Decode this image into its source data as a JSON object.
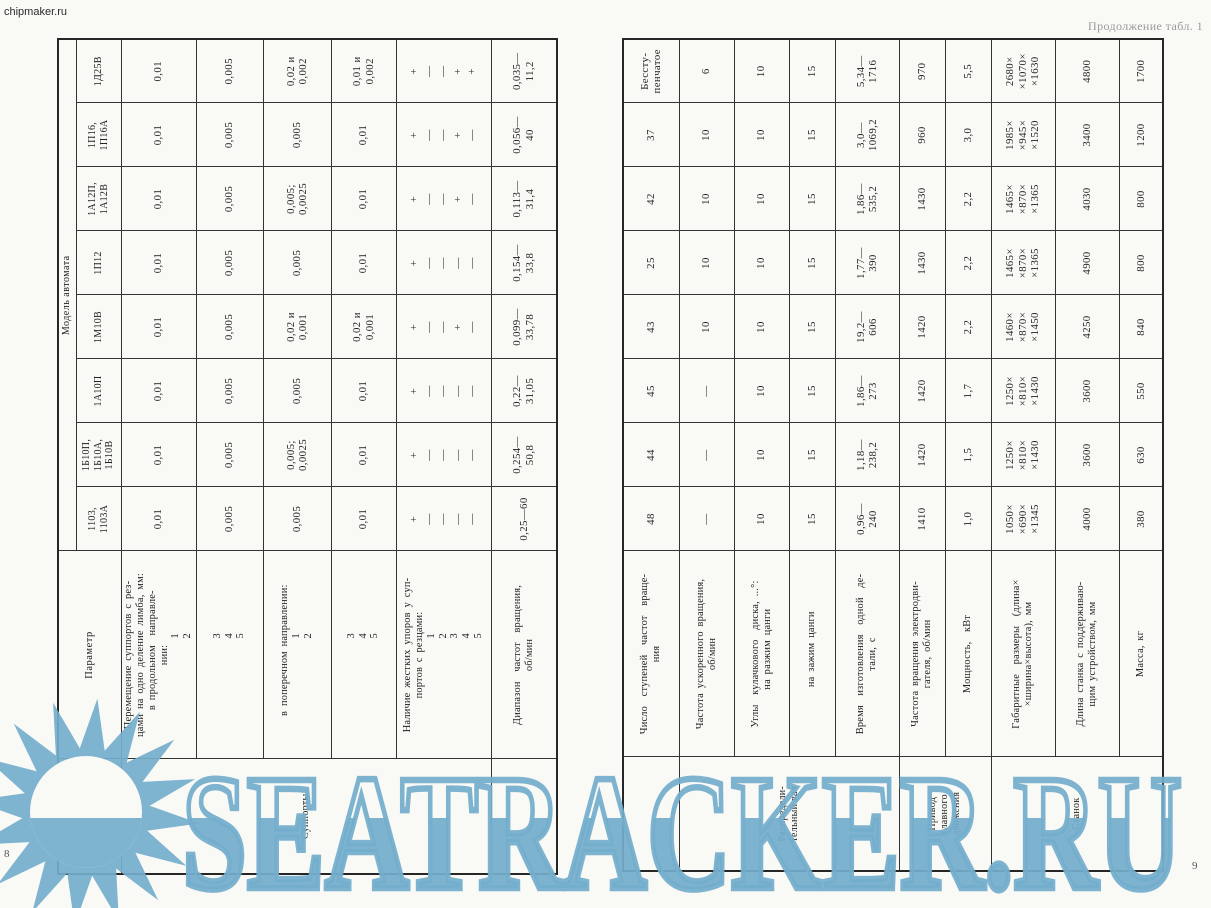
{
  "page": {
    "chipmaker": "chipmaker.ru",
    "caption": "Продолжение табл. 1",
    "page_number_left": "8",
    "page_number_right": "9",
    "watermark": {
      "text": "SEATRACKER.RU",
      "color": "#74aecd",
      "logo": "sun-over-sea-icon"
    }
  },
  "left_table": {
    "object_label": "Объект",
    "parameter_label": "Параметр",
    "model_group_label": "Модель автомата",
    "models": [
      "1103,\n1103А",
      "1Б10П,\n1Б10А,\n1Б10В",
      "1А10П",
      "1М10В",
      "1П12",
      "1А12П,\n1А12В",
      "1П16,\n1П16А",
      "1Д25В"
    ],
    "object_groups": [
      {
        "label": "Суппорты",
        "rows": 5
      },
      {
        "label": "",
        "rows": 1
      }
    ],
    "rows": [
      {
        "parameter": "Перемещение суппортов с рез-\nцами на одно деление лимба, мм:\n  в продольном  направле-\nнии:\n        1\n        2",
        "values": [
          "0,01",
          "0,01",
          "0,01",
          "0,01",
          "0,01",
          "0,01",
          "0,01",
          "0,01"
        ]
      },
      {
        "parameter": "        3\n        4\n        5",
        "values": [
          "0,005",
          "0,005",
          "0,005",
          "0,005",
          "0,005",
          "0,005",
          "0,005",
          "0,005"
        ]
      },
      {
        "parameter": "  в поперечном направлении:\n        1\n        2",
        "values": [
          "0,005",
          "0,005;\n0,0025",
          "0,005",
          "0,02 и\n0,001",
          "0,005",
          "0,005;\n0,0025",
          "0,005",
          "0,02 и\n0,002"
        ]
      },
      {
        "parameter": "        3\n        4\n        5",
        "values": [
          "0,01",
          "0,01",
          "0,01",
          "0,02 и\n0,001",
          "0,01",
          "0,01",
          "0,01",
          "0,01 и\n0,002"
        ]
      },
      {
        "parameter": "Наличие жестких упоров у суп-\nпортов с резцами:\n        1\n        2\n        3\n        4\n        5",
        "values": [
          "+\n—\n—\n—\n—",
          "+\n—\n—\n—\n—",
          "+\n—\n—\n—\n—",
          "+\n—\n—\n+\n—",
          "+\n—\n—\n—\n—",
          "+\n—\n—\n+\n—",
          "+\n—\n—\n+\n—",
          "+\n—\n—\n+\n+"
        ],
        "style": "stops"
      },
      {
        "parameter": "Диапазон  частот  вращения,\nоб/мин",
        "values": [
          "0,25—60",
          "0,254—\n50,8",
          "0,22—\n31,05",
          "0,099—\n33,78",
          "0,154—\n33,8",
          "0,113—\n31,4",
          "0,056—\n40",
          "0,035—\n11,2"
        ]
      }
    ]
  },
  "right_table": {
    "object_groups": [
      {
        "label": "",
        "rows": 1
      },
      {
        "label": "Распредели-\nтельный вал",
        "rows": 4
      },
      {
        "label": "Привод\nглавного\nдвижения",
        "rows": 2
      },
      {
        "label": "Станок",
        "rows": 3
      }
    ],
    "rows": [
      {
        "parameter": "Число  ступеней  частот  враще-\nния",
        "values": [
          "48",
          "44",
          "45",
          "43",
          "25",
          "42",
          "37",
          "Бессту-\nпенчатое"
        ]
      },
      {
        "parameter": "Частота ускоренного вращения,\nоб/мин",
        "values": [
          "—",
          "—",
          "—",
          "10",
          "10",
          "10",
          "10",
          "6"
        ]
      },
      {
        "parameter": "Углы  кулачкового  диска, ...°:\n  на разжим цанги",
        "values": [
          "10",
          "10",
          "10",
          "10",
          "10",
          "10",
          "10",
          "10"
        ]
      },
      {
        "parameter": "  на зажим цанги",
        "values": [
          "15",
          "15",
          "15",
          "15",
          "15",
          "15",
          "15",
          "15"
        ]
      },
      {
        "parameter": "Время  изготовления  одной  де-\nтали, с",
        "values": [
          "0,96—\n240",
          "1,18—\n238,2",
          "1,86—\n273",
          "19,2—\n606",
          "1,77—\n390",
          "1,86—\n535,2",
          "3,0—\n1069,2",
          "5,34—\n1716"
        ]
      },
      {
        "parameter": "Частота вращения электродви-\nгателя, об/мин",
        "values": [
          "1410",
          "1420",
          "1420",
          "1420",
          "1430",
          "1430",
          "960",
          "970"
        ]
      },
      {
        "parameter": "Мощность,  кВт",
        "values": [
          "1,0",
          "1,5",
          "1,7",
          "2,2",
          "2,2",
          "2,2",
          "3,0",
          "5,5"
        ]
      },
      {
        "parameter": "Габаритные  размеры  (длина×\n×ширина×высота), мм",
        "values": [
          "1050×\n×690×\n×1345",
          "1250×\n×810×\n×1430",
          "1250×\n×810×\n×1430",
          "1460×\n×870×\n×1450",
          "1465×\n×870×\n×1365",
          "1465×\n×870×\n×1365",
          "1985×\n×945×\n×1520",
          "2680×\n×1070×\n×1630"
        ]
      },
      {
        "parameter": "Длина станка с поддерживаю-\nщим устройством, мм",
        "values": [
          "4000",
          "3600",
          "3600",
          "4250",
          "4900",
          "4030",
          "3400",
          "4800"
        ]
      },
      {
        "parameter": "Масса, кг",
        "values": [
          "380",
          "630",
          "550",
          "840",
          "800",
          "800",
          "1200",
          "1700"
        ]
      }
    ]
  }
}
